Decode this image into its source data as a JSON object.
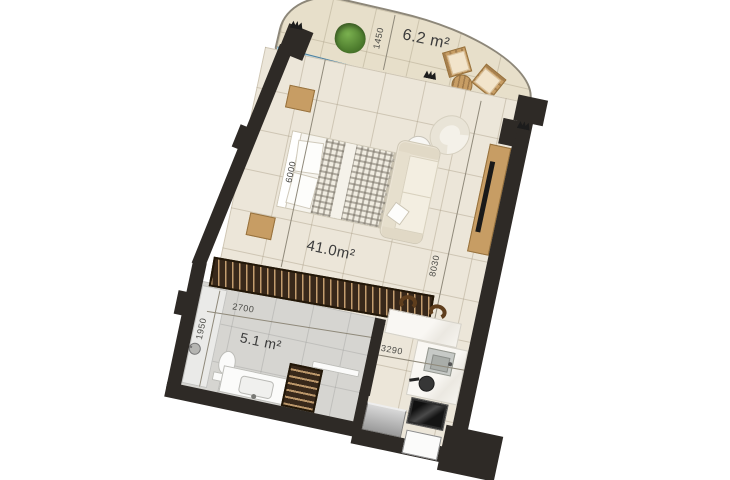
{
  "labels": {
    "balcony_area": "6.2 m²",
    "living_area": "41.0m²",
    "bathroom_area": "5.1 m²"
  },
  "dimensions": {
    "balcony_depth": "1450",
    "bedroom_wall": "6000",
    "apartment_length": "8030",
    "wardrobe_width": "2700",
    "bathroom_width": "1950",
    "kitchen_width": "3290"
  },
  "colors": {
    "wall": "#2e2a26",
    "floor_tile": "#ece6d9",
    "balcony_floor": "#e7dfca",
    "bathroom_floor": "#d6d5d1",
    "wood": "#c79d64",
    "dark_wood": "#38281a",
    "glass_balustrade": "#a8d9f1",
    "fabric": "#ece5d6",
    "plant_green": "#4e7d2e"
  },
  "furniture_icons": [
    "plant",
    "balcony-chairs",
    "balcony-table",
    "double-bed",
    "nightstand",
    "armchair",
    "side-table",
    "sofa",
    "tv-console",
    "tv",
    "wardrobe",
    "shower",
    "toilet",
    "vanity-basin",
    "towel-radiator",
    "bar-counter",
    "bar-stool",
    "kitchen-sink",
    "cooktop-pan",
    "oven",
    "fridge",
    "entry-door"
  ]
}
